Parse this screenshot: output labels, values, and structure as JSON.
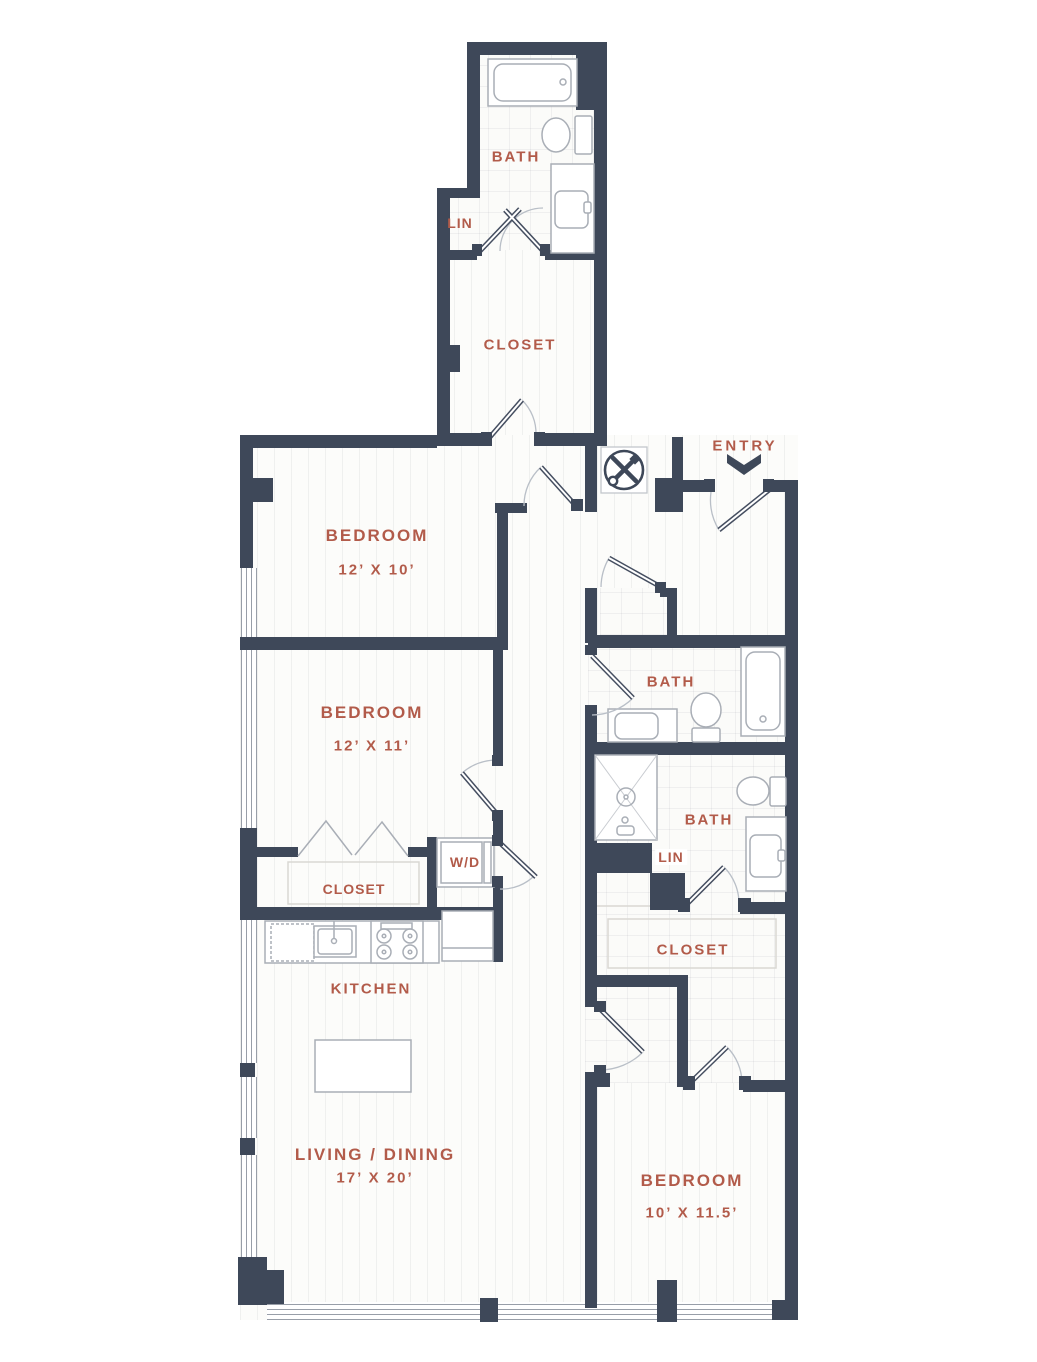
{
  "rooms": {
    "bath_top": {
      "label": "BATH"
    },
    "lin_top": {
      "label": "LIN"
    },
    "closet_top": {
      "label": "CLOSET"
    },
    "bedroom_1": {
      "label": "BEDROOM",
      "dims": "12’ X 10’"
    },
    "bedroom_2": {
      "label": "BEDROOM",
      "dims": "12’ X 11’"
    },
    "bath_2": {
      "label": "BATH"
    },
    "bath_3": {
      "label": "BATH"
    },
    "lin_2": {
      "label": "LIN"
    },
    "laundry": {
      "label": "W/D"
    },
    "closet_bed2": {
      "label": "CLOSET"
    },
    "closet_bed3": {
      "label": "CLOSET"
    },
    "kitchen": {
      "label": "KITCHEN"
    },
    "living_dining": {
      "label": "LIVING / DINING",
      "dims": "17’ X 20’"
    },
    "bedroom_3": {
      "label": "BEDROOM",
      "dims": "10’ X 11.5’"
    }
  },
  "entry": {
    "label": "ENTRY"
  },
  "icons": {
    "utility": "crossed-tools-icon",
    "entry_marker": "chevron-down-icon"
  },
  "colors": {
    "wall": "#3e4859",
    "label_text": "#b25b4a",
    "fixture_line": "#a9aeb6",
    "door_arc": "#b9bfc7"
  }
}
